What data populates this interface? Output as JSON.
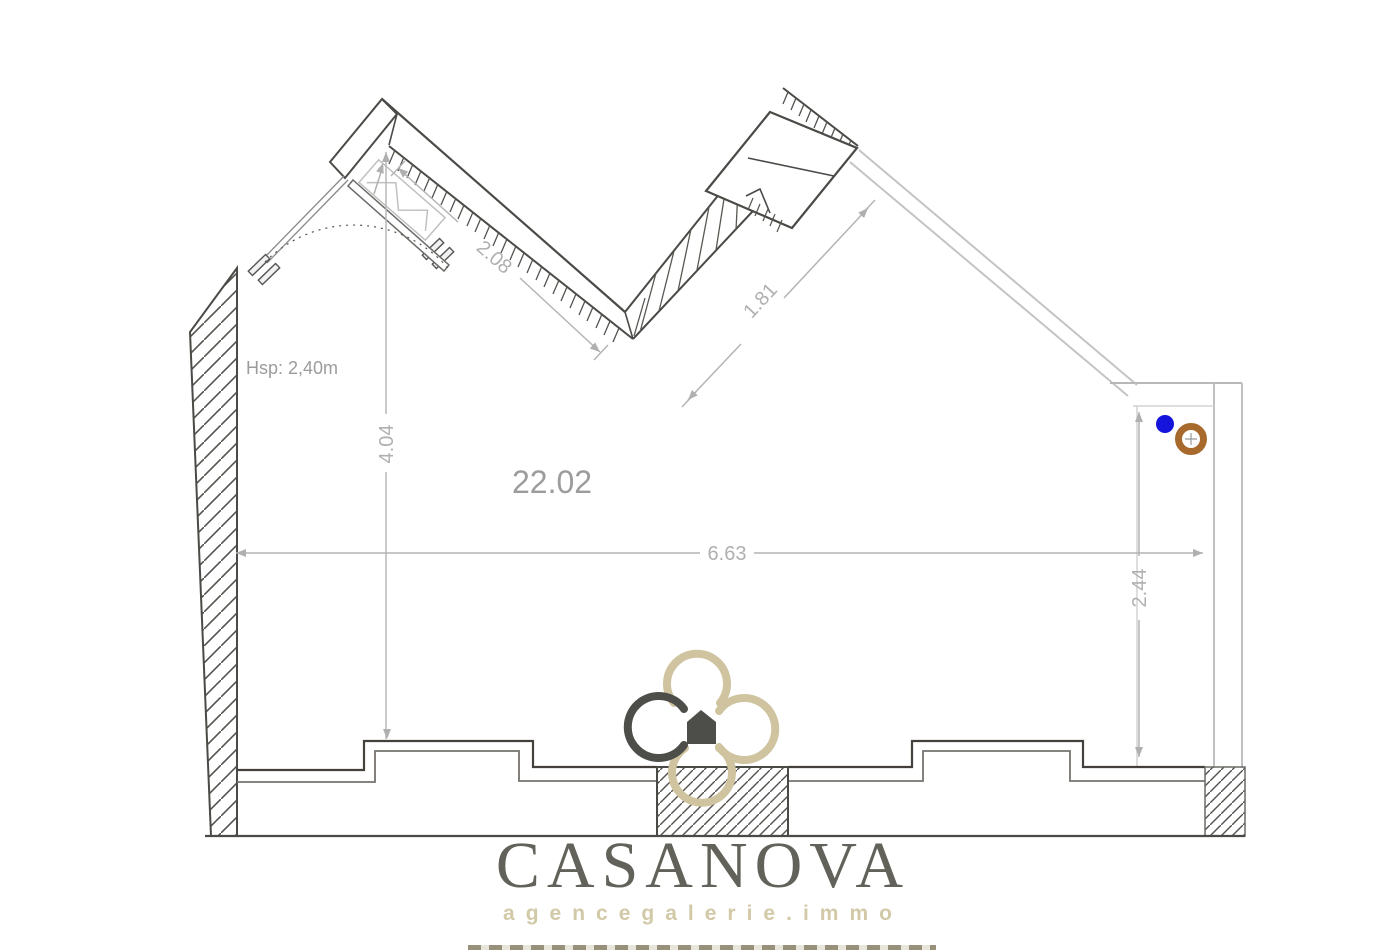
{
  "plan": {
    "area_label": "22.02",
    "ceiling_height_label": "Hsp: 2,40m",
    "dimensions": {
      "top_left_wall": "2.08",
      "top_right_wall": "1.81",
      "interior_height": "4.04",
      "room_width": "6.63",
      "right_wall_height": "2.44"
    },
    "colors": {
      "wall_line": "#4a4a46",
      "dimension_gray": "#b0b0b0",
      "label_gray": "#9c9c9c",
      "blue_marker": "#1414dc",
      "ring_marker": "#a86a2c"
    }
  },
  "branding": {
    "name": "CASANOVA",
    "tagline": "agencegalerie.immo",
    "beige": "#cfc5a3",
    "dark": "#62625a"
  }
}
